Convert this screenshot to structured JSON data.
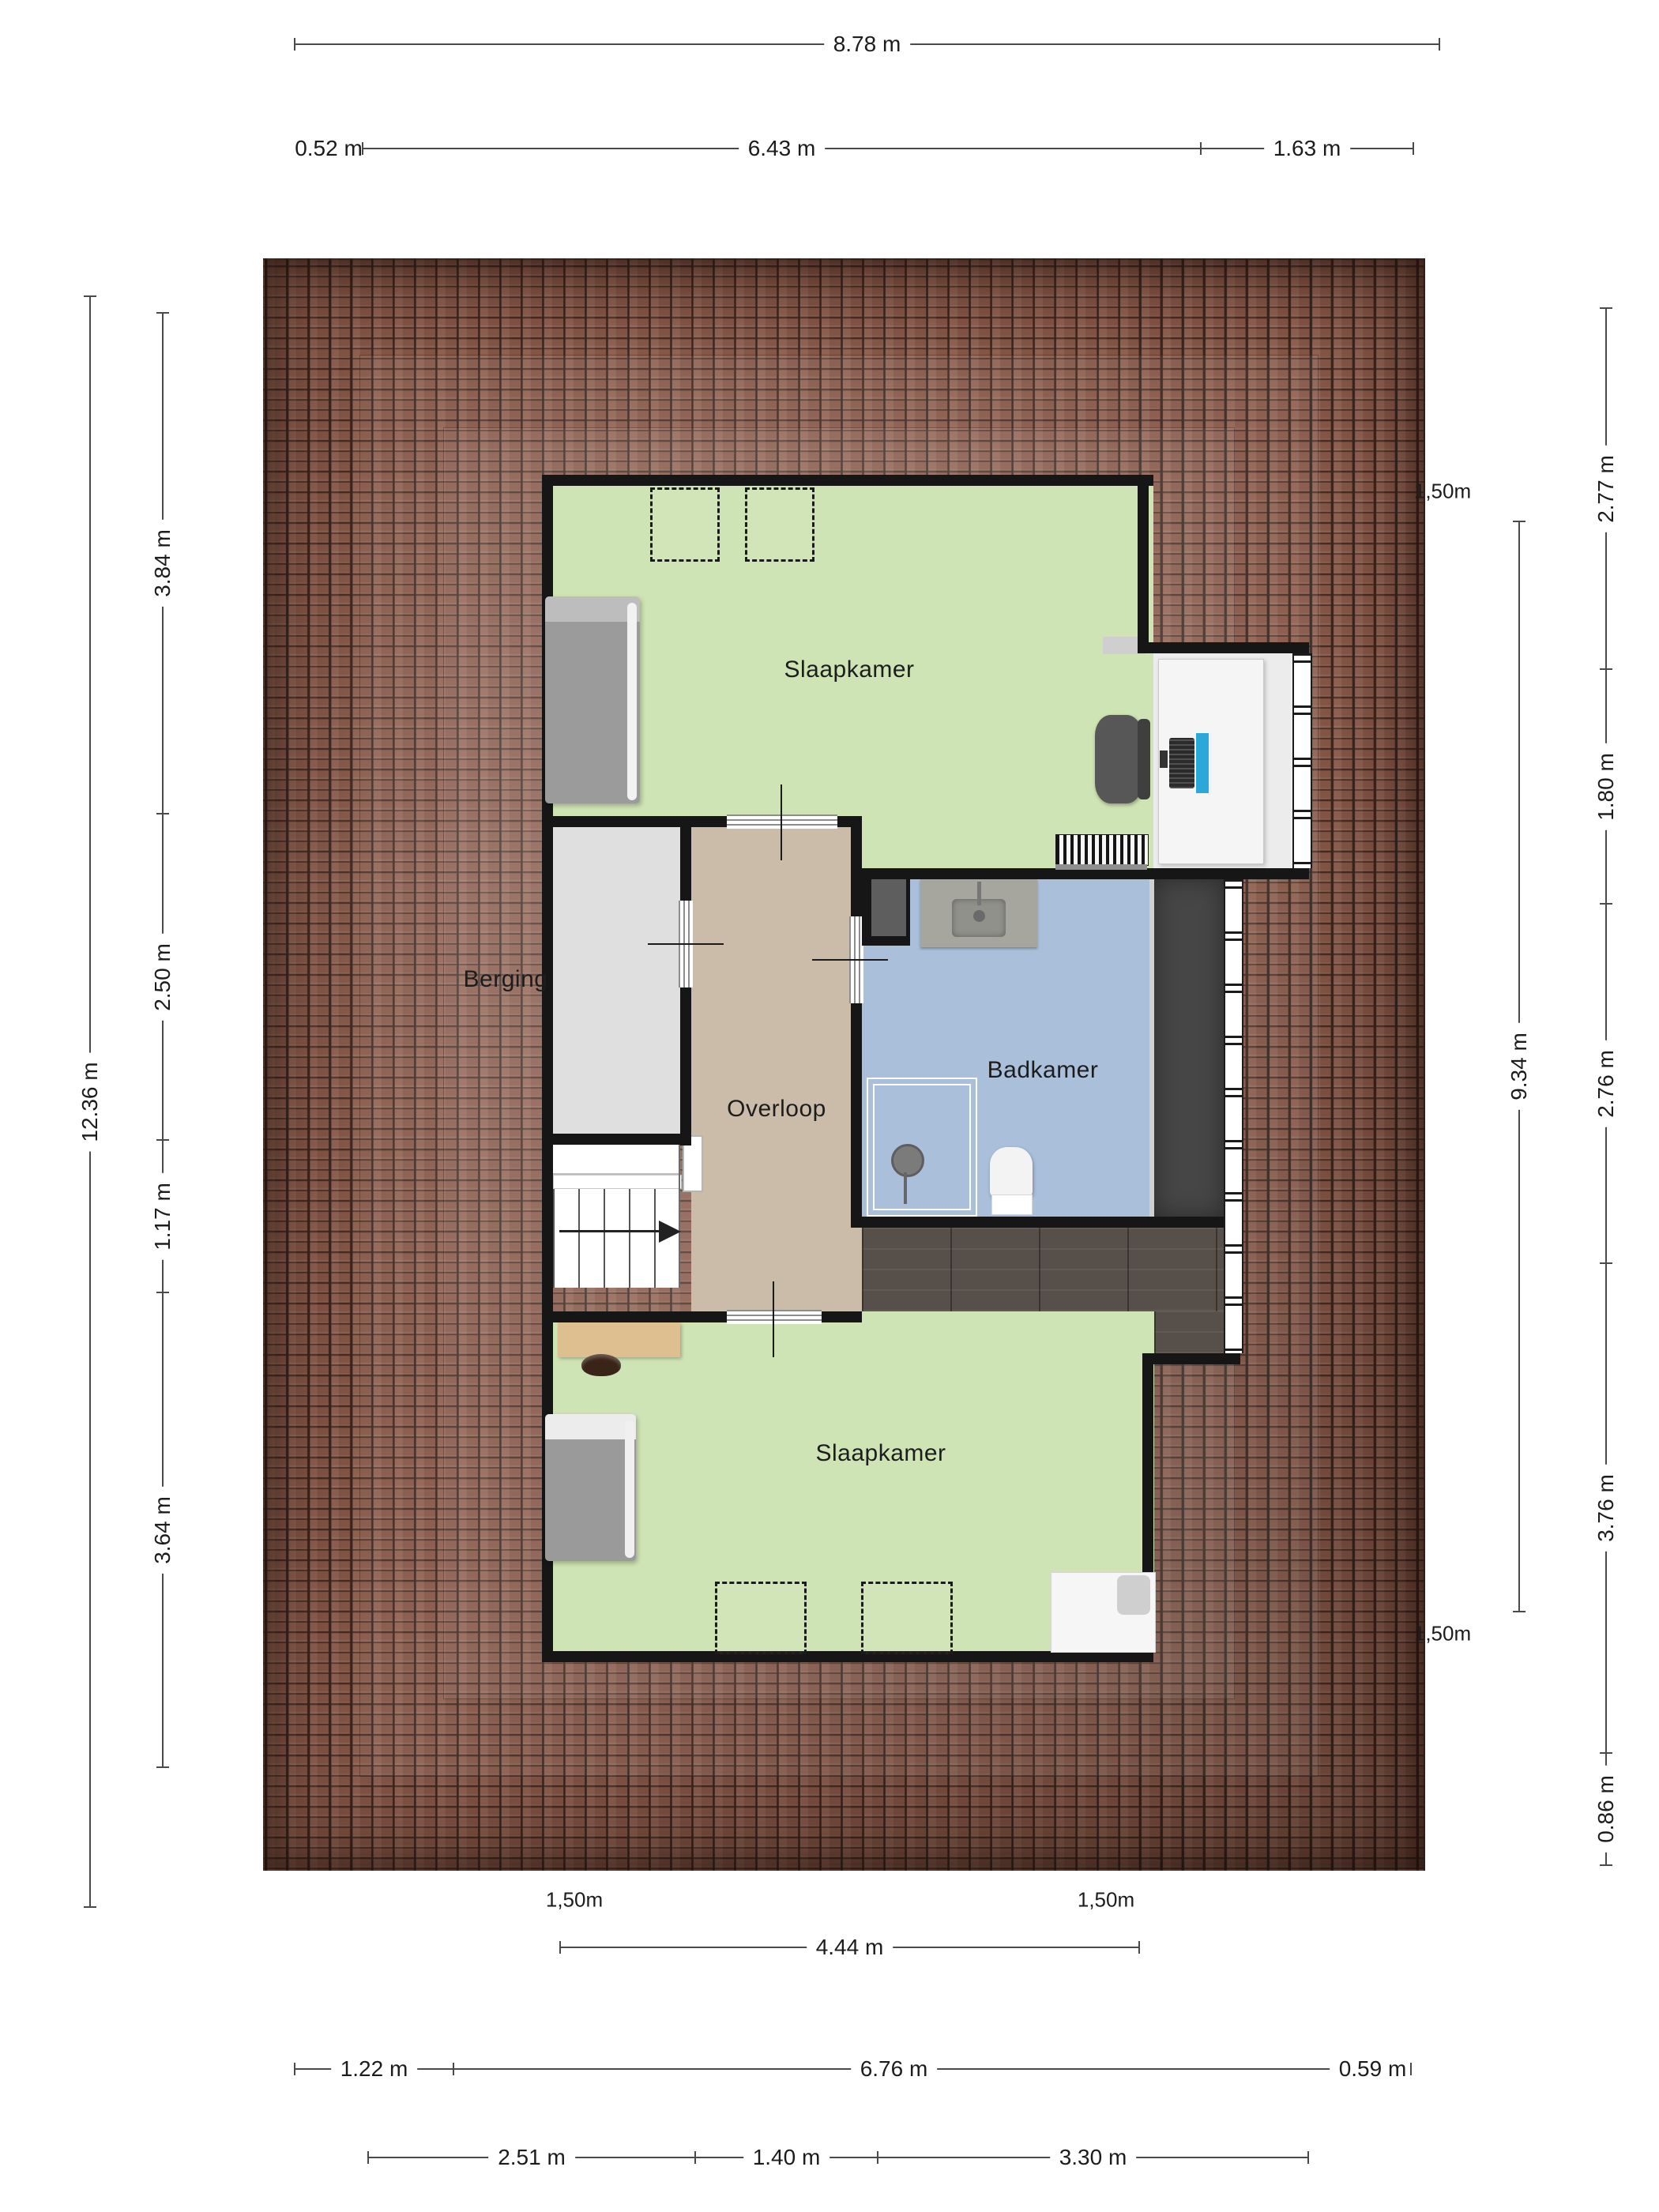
{
  "floorplan": {
    "rooms": {
      "bedroom_top": {
        "label": "Slaapkamer"
      },
      "storage": {
        "label": "Berging"
      },
      "landing": {
        "label": "Overloop"
      },
      "bathroom": {
        "label": "Badkamer"
      },
      "bedroom_bottom": {
        "label": "Slaapkamer"
      }
    },
    "dimensions": {
      "top_total": "8.78 m",
      "top_segments": [
        "0.52 m",
        "6.43 m",
        "1.63 m"
      ],
      "left_total": "12.36 m",
      "left_segments": [
        "3.84 m",
        "2.50 m",
        "1.17 m",
        "3.64 m"
      ],
      "right_total": "9.34 m",
      "right_segments": [
        "2.77 m",
        "1.80 m",
        "2.76 m",
        "3.76 m",
        "0.86 m"
      ],
      "bottom_inner": "4.44 m",
      "bottom_segments": [
        "1.22 m",
        "6.76 m",
        "0.59 m"
      ],
      "bottom_interior_segments": [
        "2.51 m",
        "1.40 m",
        "3.30 m"
      ],
      "headroom_labels": [
        "1,50m",
        "1,50m",
        "1,50m",
        "1,50m"
      ]
    },
    "icons": {
      "stairs_direction": "right-arrow"
    },
    "colors": {
      "wall": "#161616",
      "roof_base": "#8a5a49",
      "roof_seam": "#2f1a13",
      "floor_green": "#cfe4b4",
      "floor_tan": "#cbbcaa",
      "floor_gray": "#dfdfdf",
      "floor_blue": "#a9bfda",
      "floor_wood": "#57504a",
      "wardrobe_dark": "#464646",
      "monitor_blue": "#2ba7da",
      "dim_line": "#4a4a4a",
      "dim_text": "#1c1c1c"
    }
  }
}
